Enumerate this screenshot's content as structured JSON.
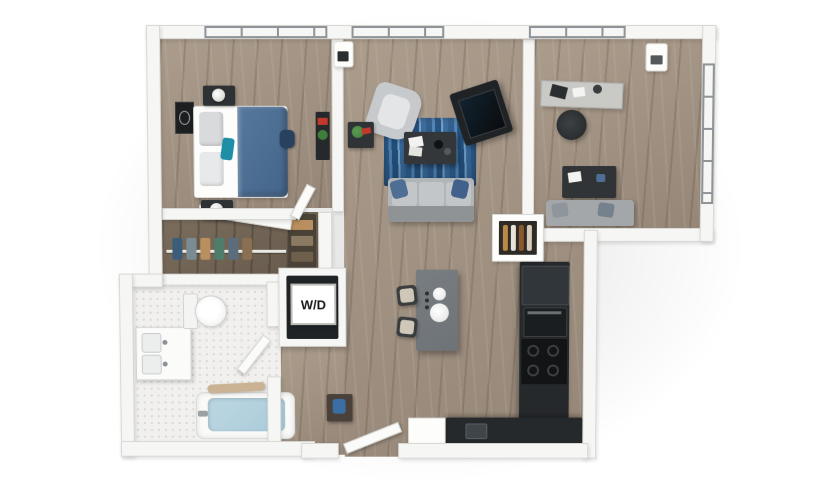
{
  "labels": {
    "washer_dryer": "W/D"
  },
  "colors": {
    "bg": "#ffffff",
    "wall": "#f6f6f4",
    "wall_edge": "#d8d8d4",
    "floor_wood": "#ab9c8c",
    "floor_wood_dark": "#958677",
    "tile": "#f1f0ee",
    "tile_dot": "#d9d8d4",
    "frame": "#8e9497",
    "counter_dark": "#26292c",
    "island_gray": "#6e7377",
    "rug_blue": "#3c6f9f",
    "bed_blue": "#56789c",
    "sofa_gray": "#b2b5b7",
    "water_blue": "#aacbd9",
    "plant_green": "#3f7d3a",
    "accent_red": "#c0392b",
    "stool_tan": "#cfc8b8"
  },
  "scene": {
    "type": "3d-apartment-floorplan",
    "rooms": [
      {
        "name": "bedroom",
        "furniture": [
          "bed",
          "blue-duvet",
          "pillows",
          "nightstand",
          "table-lamp",
          "nightstand",
          "table-lamp",
          "wall-art",
          "bookshelf",
          "backpack"
        ]
      },
      {
        "name": "living-room",
        "furniture": [
          "armchair",
          "side-table",
          "plant",
          "area-rug",
          "coffee-table",
          "sofa",
          "throw-pillows",
          "tv-console"
        ]
      },
      {
        "name": "den",
        "furniture": [
          "desk",
          "laptop",
          "desk-lamp",
          "desk-chair",
          "table",
          "loveseat"
        ]
      },
      {
        "name": "walk-in-closet",
        "furniture": [
          "closet-rod",
          "hanging-clothes",
          "shelving",
          "closet-door"
        ]
      },
      {
        "name": "bathroom",
        "furniture": [
          "toilet",
          "vanity-sink",
          "bathtub",
          "bath-water",
          "bath-mat",
          "bathroom-door"
        ]
      },
      {
        "name": "laundry-closet",
        "furniture": [
          "washer-dryer"
        ]
      },
      {
        "name": "kitchen",
        "furniture": [
          "island",
          "island-sink",
          "bar-stool",
          "bar-stool",
          "refrigerator",
          "oven",
          "cooktop",
          "counter",
          "counter-sink",
          "wine-shelf"
        ]
      },
      {
        "name": "entry",
        "furniture": [
          "entry-door",
          "console-table"
        ]
      }
    ]
  }
}
